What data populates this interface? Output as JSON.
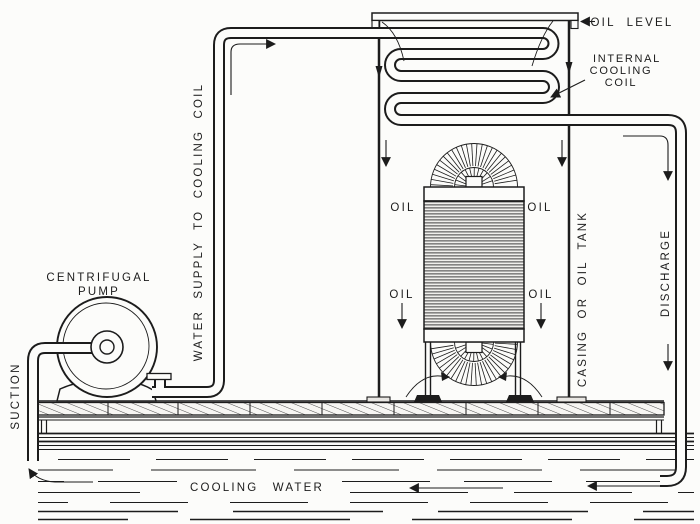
{
  "labels": {
    "oil_level": "OIL LEVEL",
    "internal_cooling_coil": [
      "INTERNAL",
      "COOLING",
      "COIL"
    ],
    "water_supply_to_cooling_coil": "WATER SUPPLY TO COOLING COIL",
    "centrifugal_pump": [
      "CENTRIFUGAL",
      "PUMP"
    ],
    "suction": "SUCTION",
    "oil": "OIL",
    "casing_or_oil_tank": "CASING OR OIL TANK",
    "discharge": "DISCHARGE",
    "cooling_water": "COOLING WATER"
  },
  "colors": {
    "ink": "#1c1c1c",
    "paper": "#fcfcfa"
  }
}
